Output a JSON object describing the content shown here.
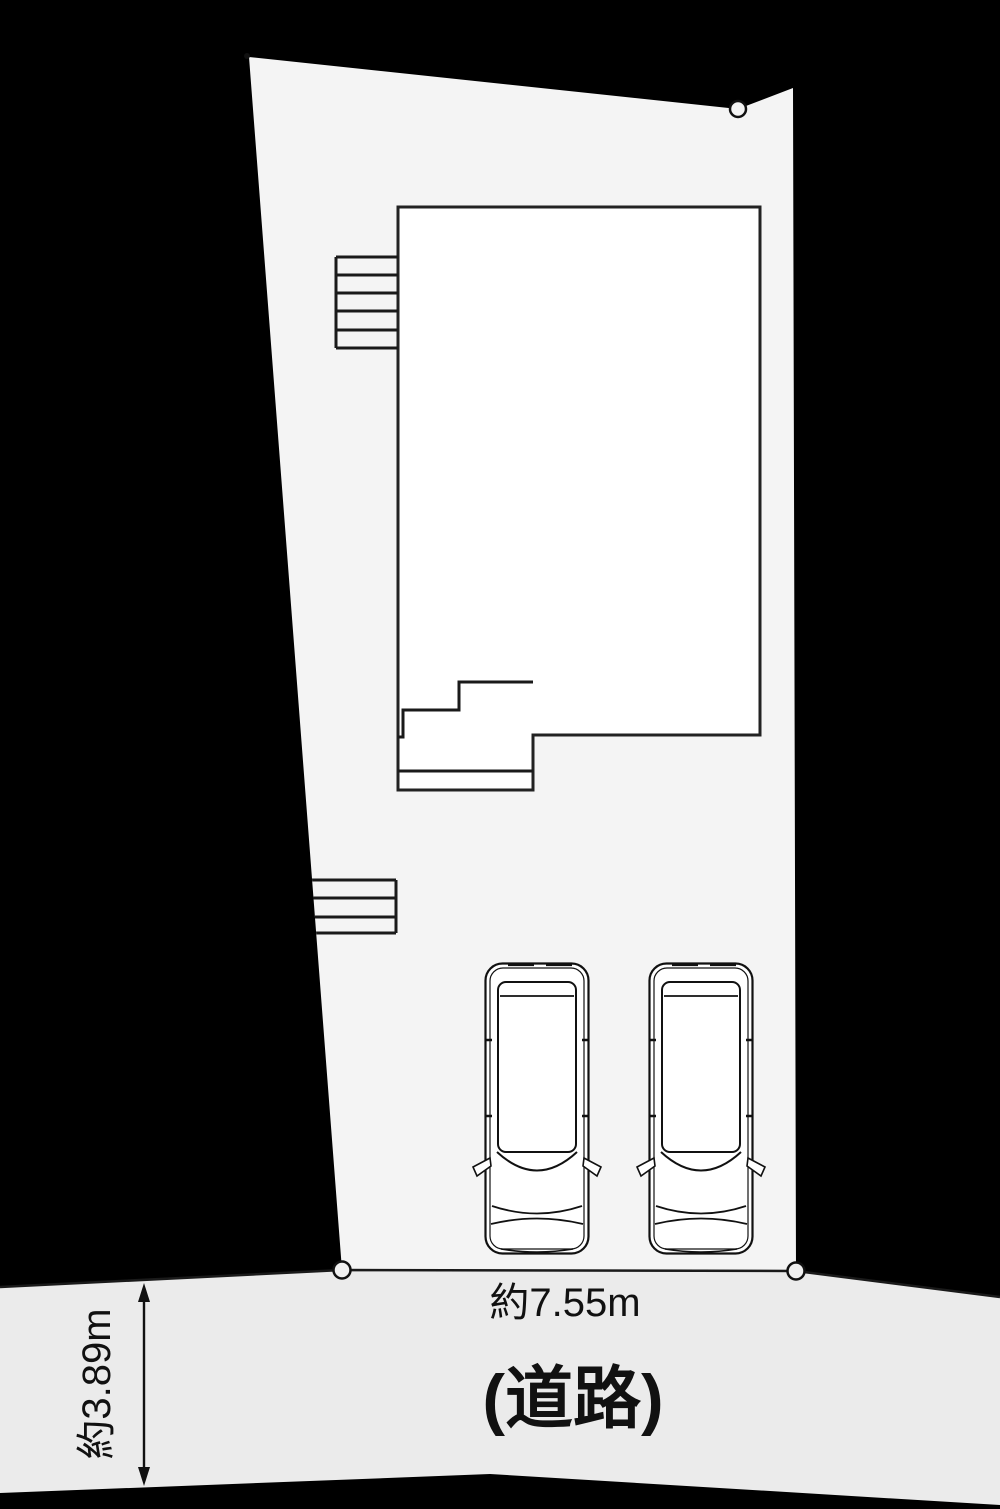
{
  "palette": {
    "background": "#000000",
    "parcel_fill": "#f4f4f4",
    "road_fill": "#ebebeb",
    "building_fill": "#ffffff",
    "line": "#1a1a1a",
    "frontage_line": "#4a4a4a"
  },
  "labels": {
    "frontage_width": "約7.55m",
    "road_name": "(道路)",
    "road_width": "約3.89m"
  }
}
